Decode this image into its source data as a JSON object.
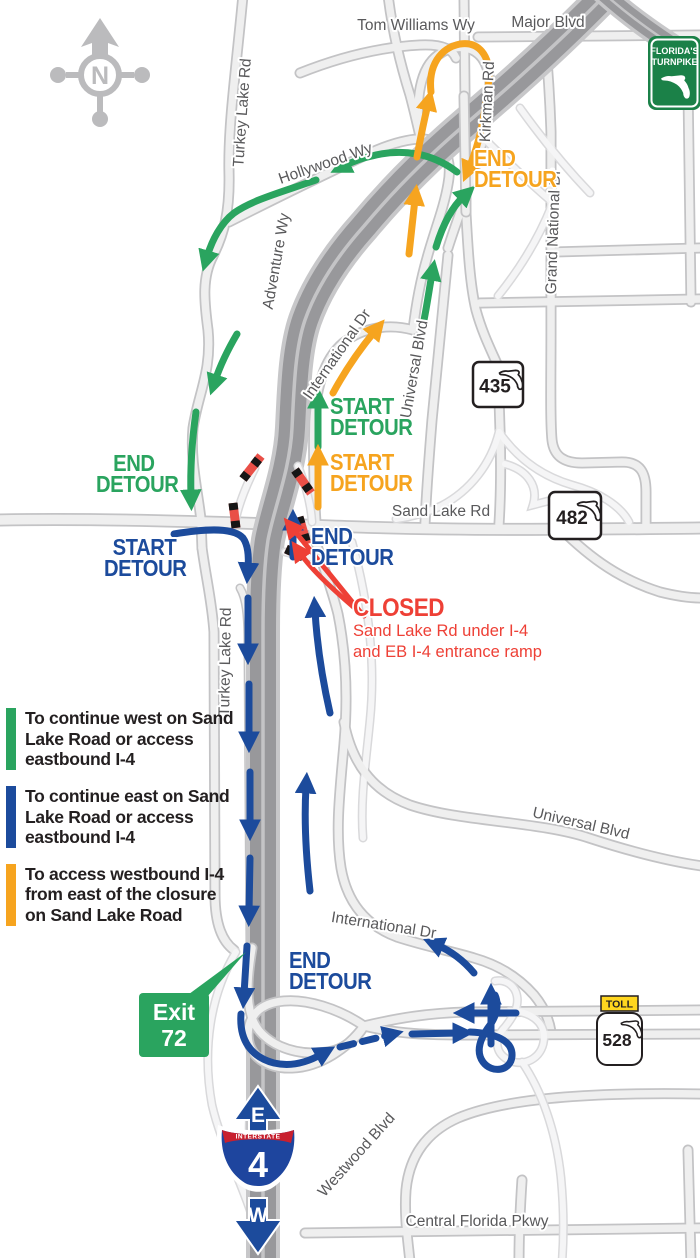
{
  "map": {
    "compass_letter": "N",
    "roads": {
      "turkey_lake_top": "Turkey Lake Rd",
      "turkey_lake_mid": "Turkey Lake Rd",
      "tom_williams": "Tom Williams Wy",
      "major_blvd": "Major Blvd",
      "kirkman": "Kirkman Rd",
      "hollywood": "Hollywood Wy",
      "adventure": "Adventure Wy",
      "grand_national": "Grand National Dr",
      "international_upper": "International Dr",
      "universal_upper": "Universal Blvd",
      "sand_lake": "Sand Lake Rd",
      "international_lower": "International Dr",
      "universal_lower": "Universal Blvd",
      "westwood": "Westwood Blvd",
      "central_florida": "Central Florida Pkwy"
    },
    "shields": {
      "turnpike": {
        "line1": "FLORIDA'S",
        "line2": "TURNPIKE"
      },
      "sr435": "435",
      "sr482": "482",
      "toll": {
        "banner": "TOLL",
        "number": "528"
      },
      "i4": {
        "banner": "INTERSTATE",
        "number": "4",
        "top": "E",
        "bottom": "W"
      }
    },
    "exit_sign": {
      "word": "Exit",
      "number": "72"
    },
    "detours": {
      "orange_end_top": {
        "line1": "END",
        "line2": "DETOUR"
      },
      "green_start": {
        "line1": "START",
        "line2": "DETOUR"
      },
      "orange_start": {
        "line1": "START",
        "line2": "DETOUR"
      },
      "green_end": {
        "line1": "END",
        "line2": "DETOUR"
      },
      "blue_start": {
        "line1": "START",
        "line2": "DETOUR"
      },
      "blue_end_mid": {
        "line1": "END",
        "line2": "DETOUR"
      },
      "blue_end_bottom": {
        "line1": "END",
        "line2": "DETOUR"
      }
    },
    "closure": {
      "title": "CLOSED",
      "line1": "Sand Lake Rd under I-4",
      "line2": "and EB I-4 entrance ramp"
    },
    "legend": {
      "items": [
        {
          "color": "#2aa45f",
          "text": "To continue west on Sand Lake Road or access eastbound I-4"
        },
        {
          "color": "#1c4b9c",
          "text": "To continue east on Sand Lake Road or access eastbound I-4"
        },
        {
          "color": "#f6a41f",
          "text": "To access westbound I-4 from east of the closure on Sand Lake Road"
        }
      ]
    },
    "colors": {
      "green": "#2aa45f",
      "blue": "#1c4b9c",
      "orange": "#f6a41f",
      "red": "#ee4036",
      "highway_gray": "#98989b",
      "road_fill": "#efefef"
    }
  }
}
